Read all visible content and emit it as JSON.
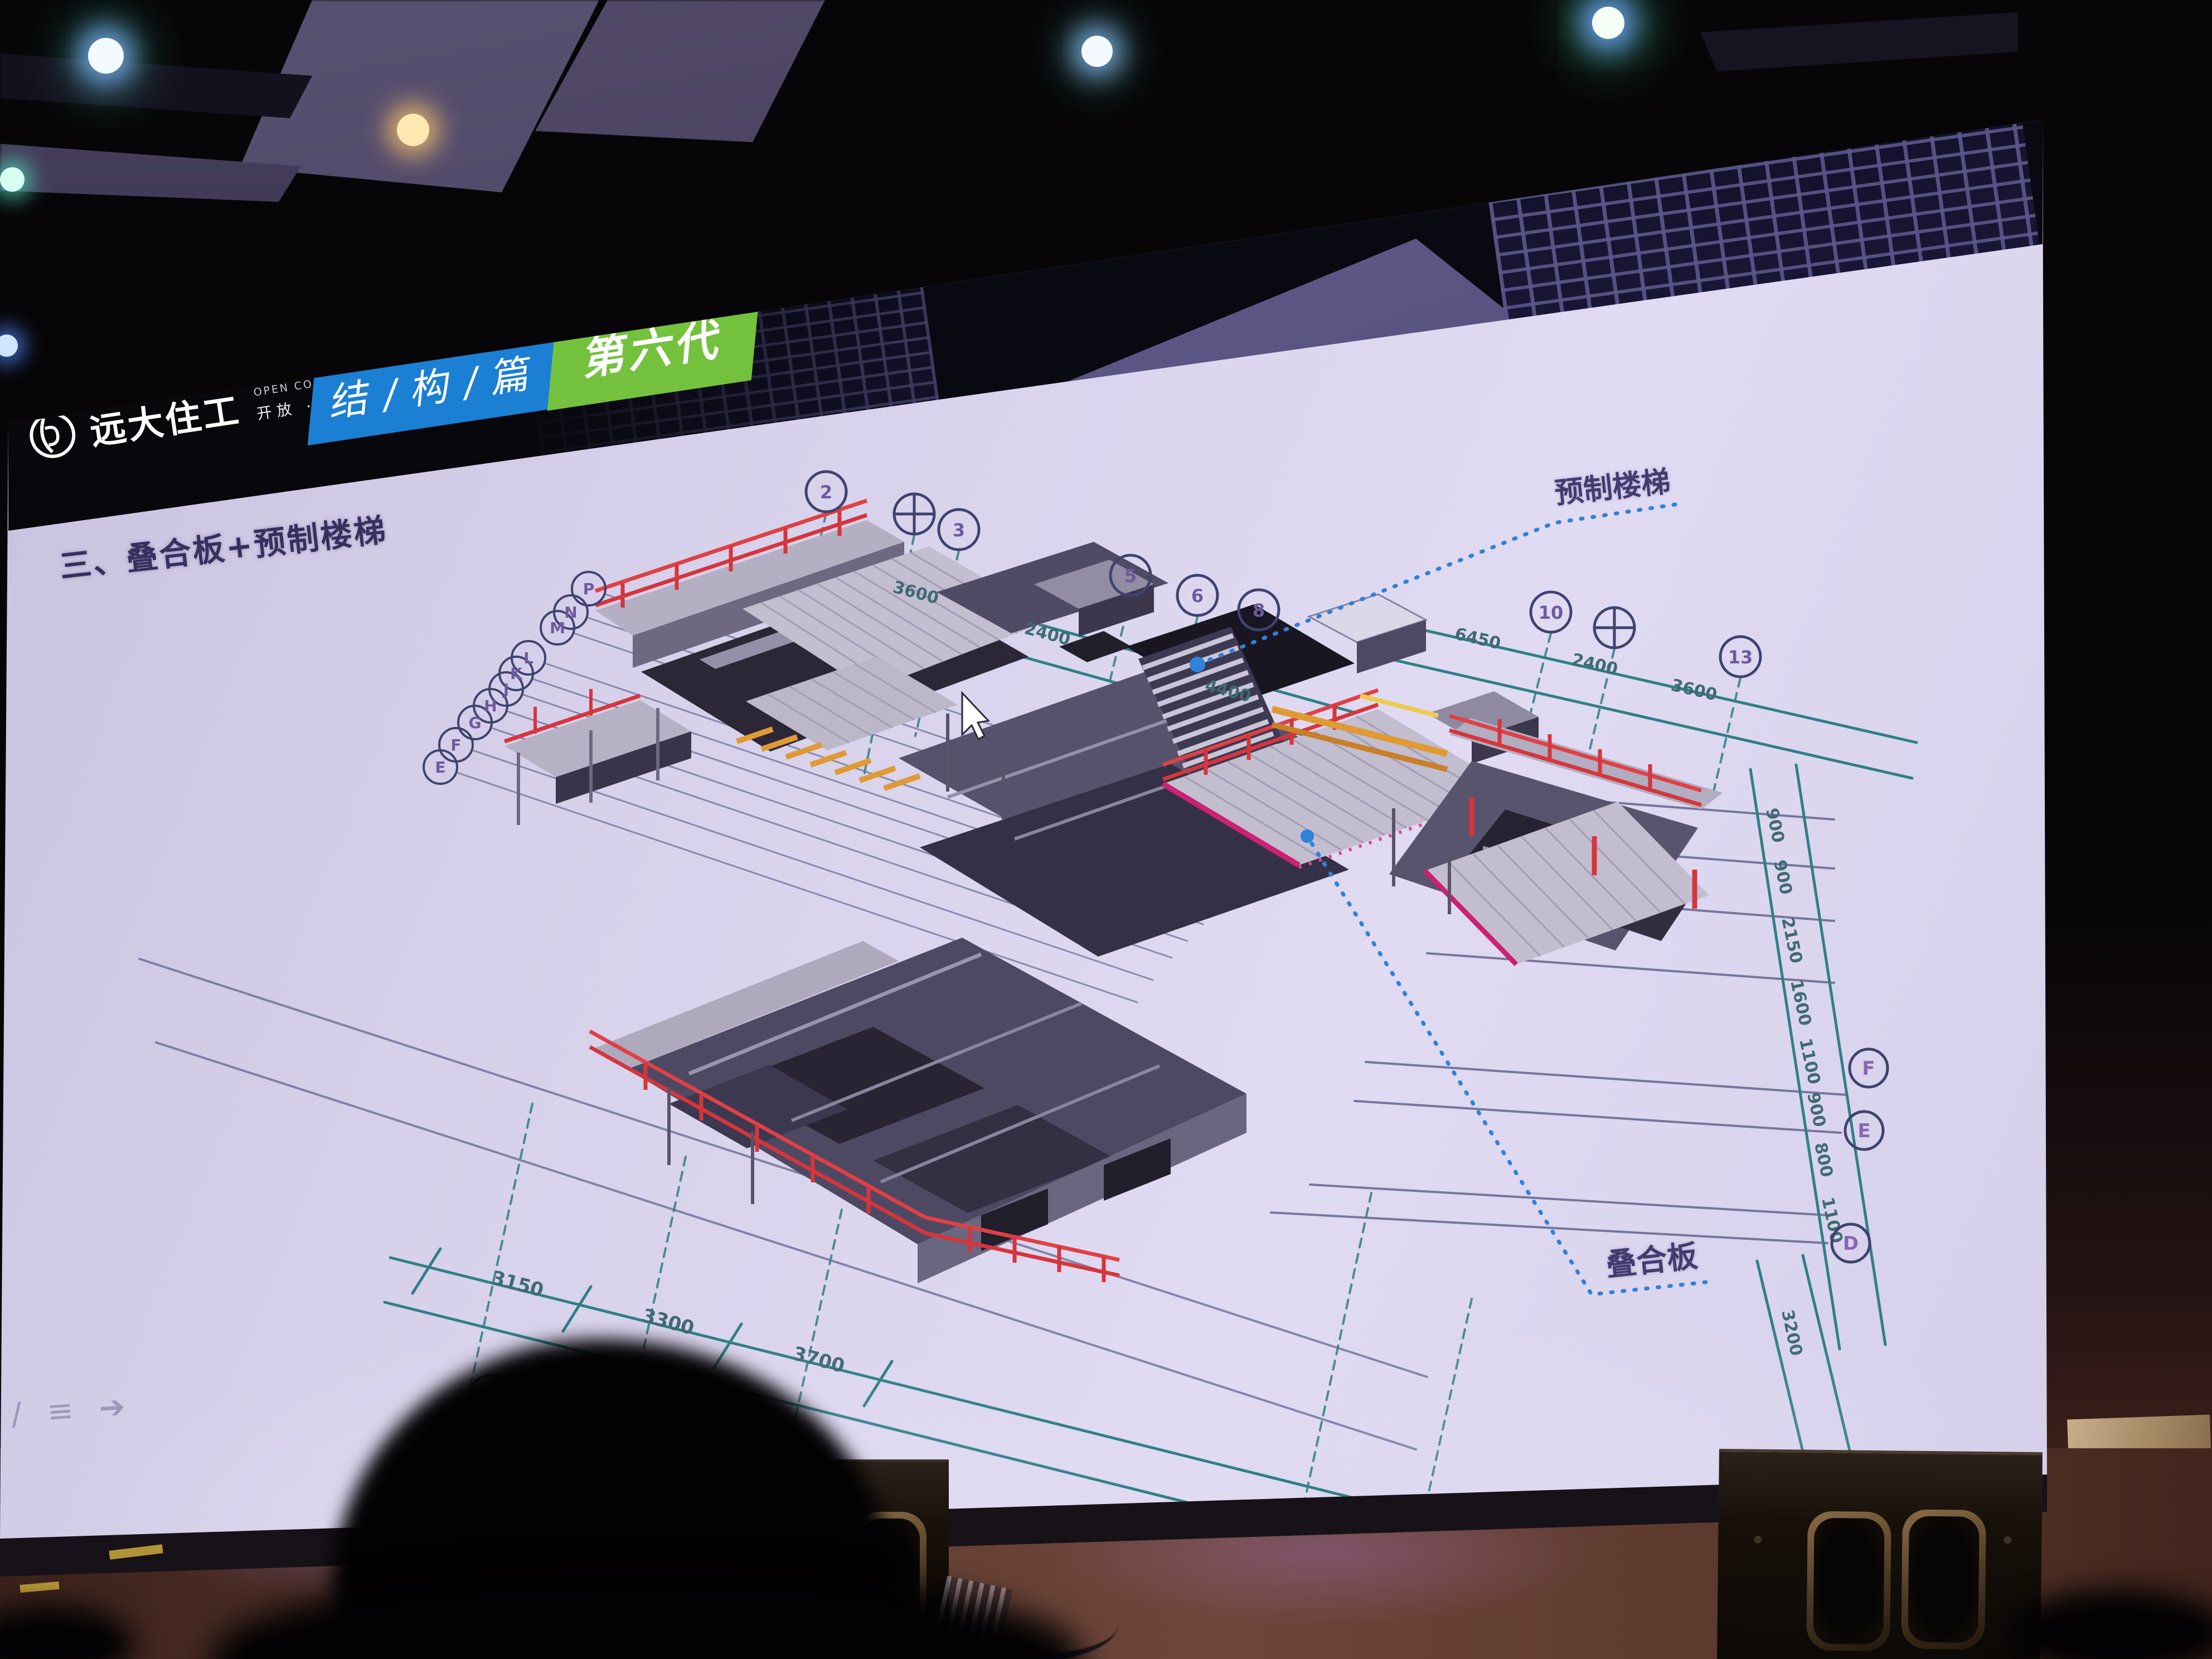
{
  "slide": {
    "logo": {
      "icon": "broad-homes-logo-icon",
      "name": "远大住工",
      "tagline_en": "OPEN COOPERATION SHARE",
      "tagline_cn": "开放 · 合作 · 分享"
    },
    "chips": [
      {
        "label": "结 / 构 / 篇",
        "color": "#1b7fd4"
      },
      {
        "label": "第六代",
        "color": "#74c13d"
      }
    ],
    "section_title": "三、叠合板+预制楼梯",
    "callouts": {
      "stairs": "预制楼梯",
      "slab": "叠合板"
    },
    "dimensions": {
      "top_left": [
        "3600",
        "2400",
        "4400"
      ],
      "top_right": [
        "6450",
        "2400",
        "3600"
      ],
      "bottom": [
        "3150",
        "3300",
        "3700"
      ],
      "right_chain": [
        "900",
        "900",
        "2150",
        "1600",
        "1100",
        "900",
        "800",
        "1100",
        "3200",
        "4900"
      ]
    },
    "grid_bubbles": {
      "top": [
        "2",
        "3",
        "5",
        "6",
        "8",
        "10",
        "13"
      ],
      "left": [
        "P",
        "N",
        "M",
        "L",
        "K",
        "J",
        "H",
        "G",
        "F",
        "E"
      ],
      "right": [
        "F",
        "E",
        "D"
      ]
    },
    "toolbar_icons": [
      {
        "name": "pen-icon",
        "glyph": "/"
      },
      {
        "name": "list-icon",
        "glyph": "≡"
      },
      {
        "name": "next-arrow-icon",
        "glyph": "➔"
      }
    ],
    "cursor": "mouse-pointer"
  },
  "colors": {
    "chip_blue": "#1b7fd4",
    "chip_green": "#74c13d",
    "dim_teal": "#2f7f86",
    "grid_navy": "#4a4e7a",
    "leader_blue": "#2f82d8",
    "railing_red": "#d6353c",
    "edge_magenta": "#cb2173",
    "beam_orange": "#e09a35",
    "slab_gray": "#c2bed0",
    "title_navy": "#36305f",
    "screen_lavender": "#d8d2ec"
  }
}
